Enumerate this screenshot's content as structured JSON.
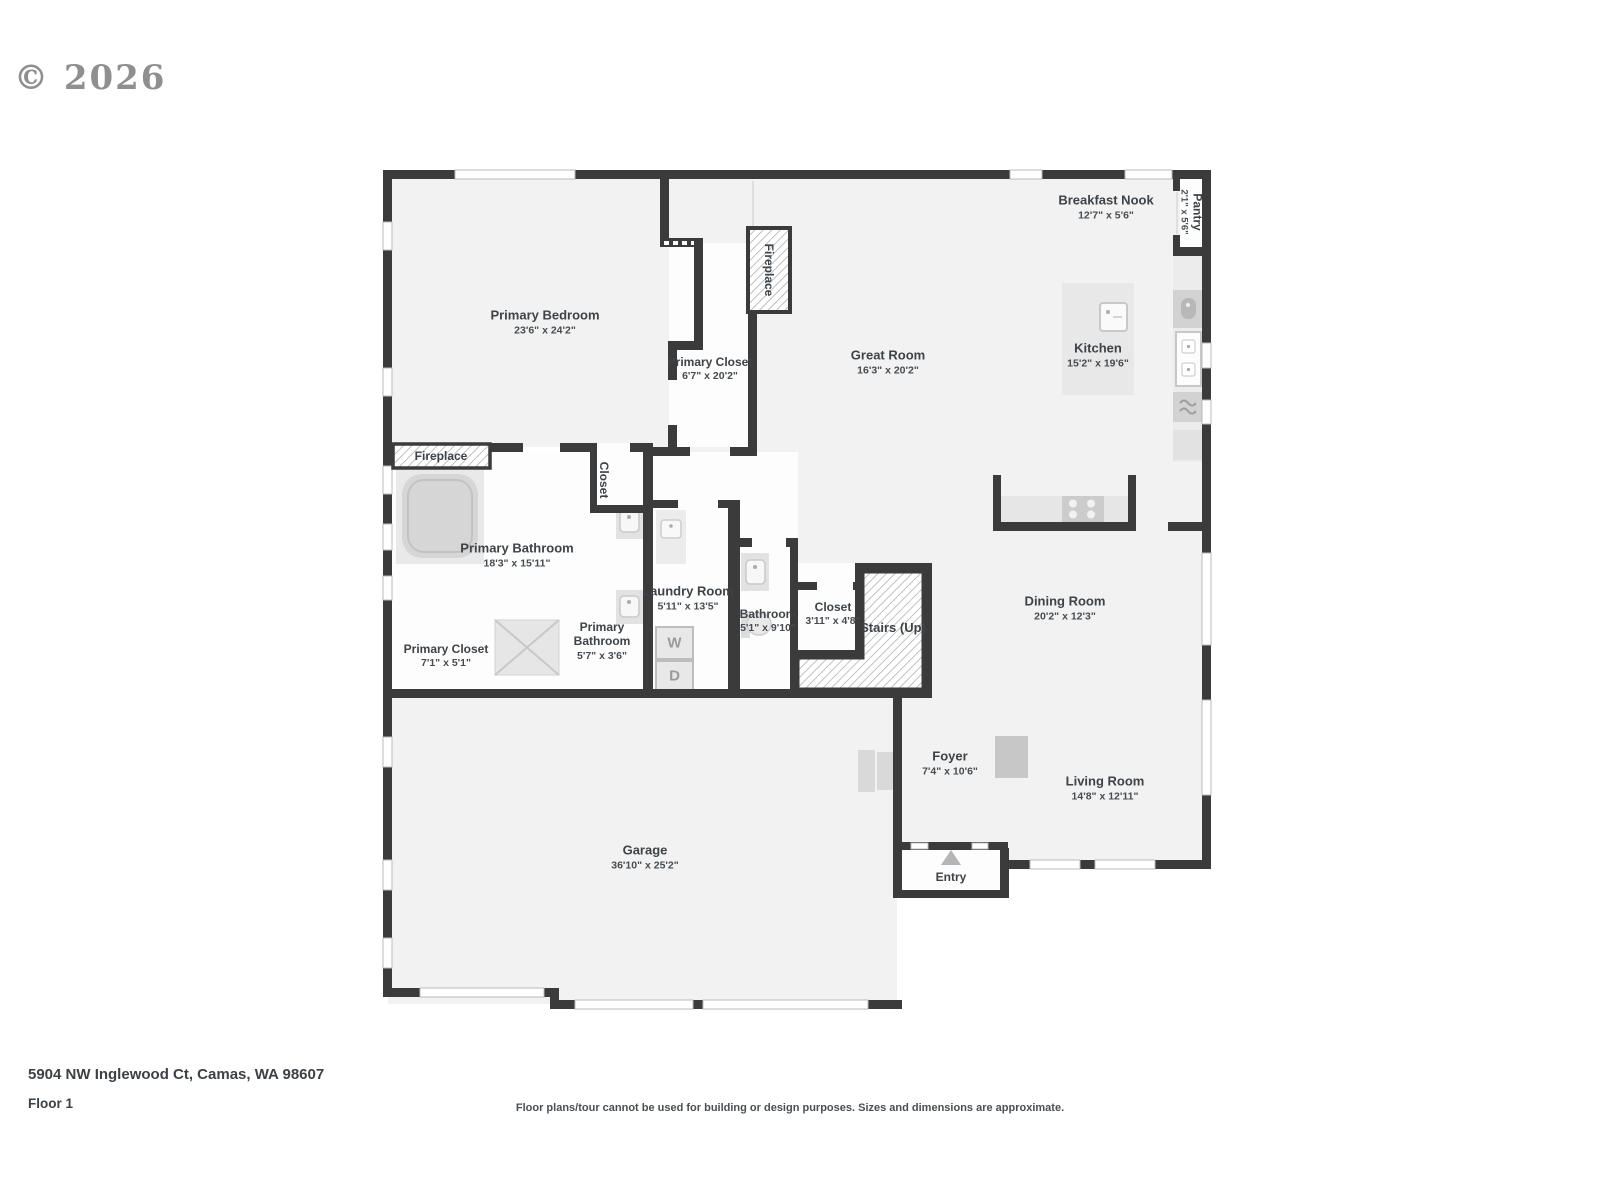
{
  "header": {
    "copyright": "© 2026"
  },
  "rooms": {
    "primary_bedroom": {
      "name": "Primary Bedroom",
      "dims": "23'6\" x 24'2\""
    },
    "primary_closet": {
      "name": "Primary Closet",
      "dims": "6'7\" x 20'2\""
    },
    "breakfast_nook": {
      "name": "Breakfast Nook",
      "dims": "12'7\" x 5'6\""
    },
    "pantry": {
      "name": "Pantry",
      "dims": "2'1\" x 5'6\""
    },
    "great_room": {
      "name": "Great Room",
      "dims": "16'3\" x 20'2\""
    },
    "kitchen": {
      "name": "Kitchen",
      "dims": "15'2\" x 19'6\""
    },
    "primary_bathroom": {
      "name": "Primary Bathroom",
      "dims": "18'3\" x 15'11\""
    },
    "laundry_room": {
      "name": "Laundry Room",
      "dims": "5'11\" x 13'5\""
    },
    "bathroom": {
      "name": "Bathroom",
      "dims": "5'1\" x 9'10\""
    },
    "closet": {
      "name": "Closet",
      "dims": "3'11\" x 4'8\""
    },
    "dining_room": {
      "name": "Dining Room",
      "dims": "20'2\" x 12'3\""
    },
    "primary_closet_2": {
      "name": "Primary Closet",
      "dims": "7'1\" x 5'1\""
    },
    "primary_bathroom_2": {
      "name": "Primary Bathroom",
      "dims": "5'7\" x 3'6\""
    },
    "garage": {
      "name": "Garage",
      "dims": "36'10\" x 25'2\""
    },
    "foyer": {
      "name": "Foyer",
      "dims": "7'4\" x 10'6\""
    },
    "living_room": {
      "name": "Living Room",
      "dims": "14'8\" x 12'11\""
    }
  },
  "features": {
    "fireplace_great_room": "Fireplace",
    "fireplace_bathroom": "Fireplace",
    "closet_hall": "Closet",
    "stairs": "Stairs (Up)",
    "entry": "Entry",
    "washer": "W",
    "dryer": "D"
  },
  "footer": {
    "address": "5904 NW Inglewood Ct, Camas, WA 98607",
    "floor_label": "Floor 1",
    "disclaimer": "Floor plans/tour cannot be used for building or design purposes. Sizes and dimensions are approximate."
  },
  "colors": {
    "wall": "#3b3b3b",
    "floor": "#f2f2f2",
    "fixture": "#e8e8e8",
    "label_text": "#3e4348"
  }
}
